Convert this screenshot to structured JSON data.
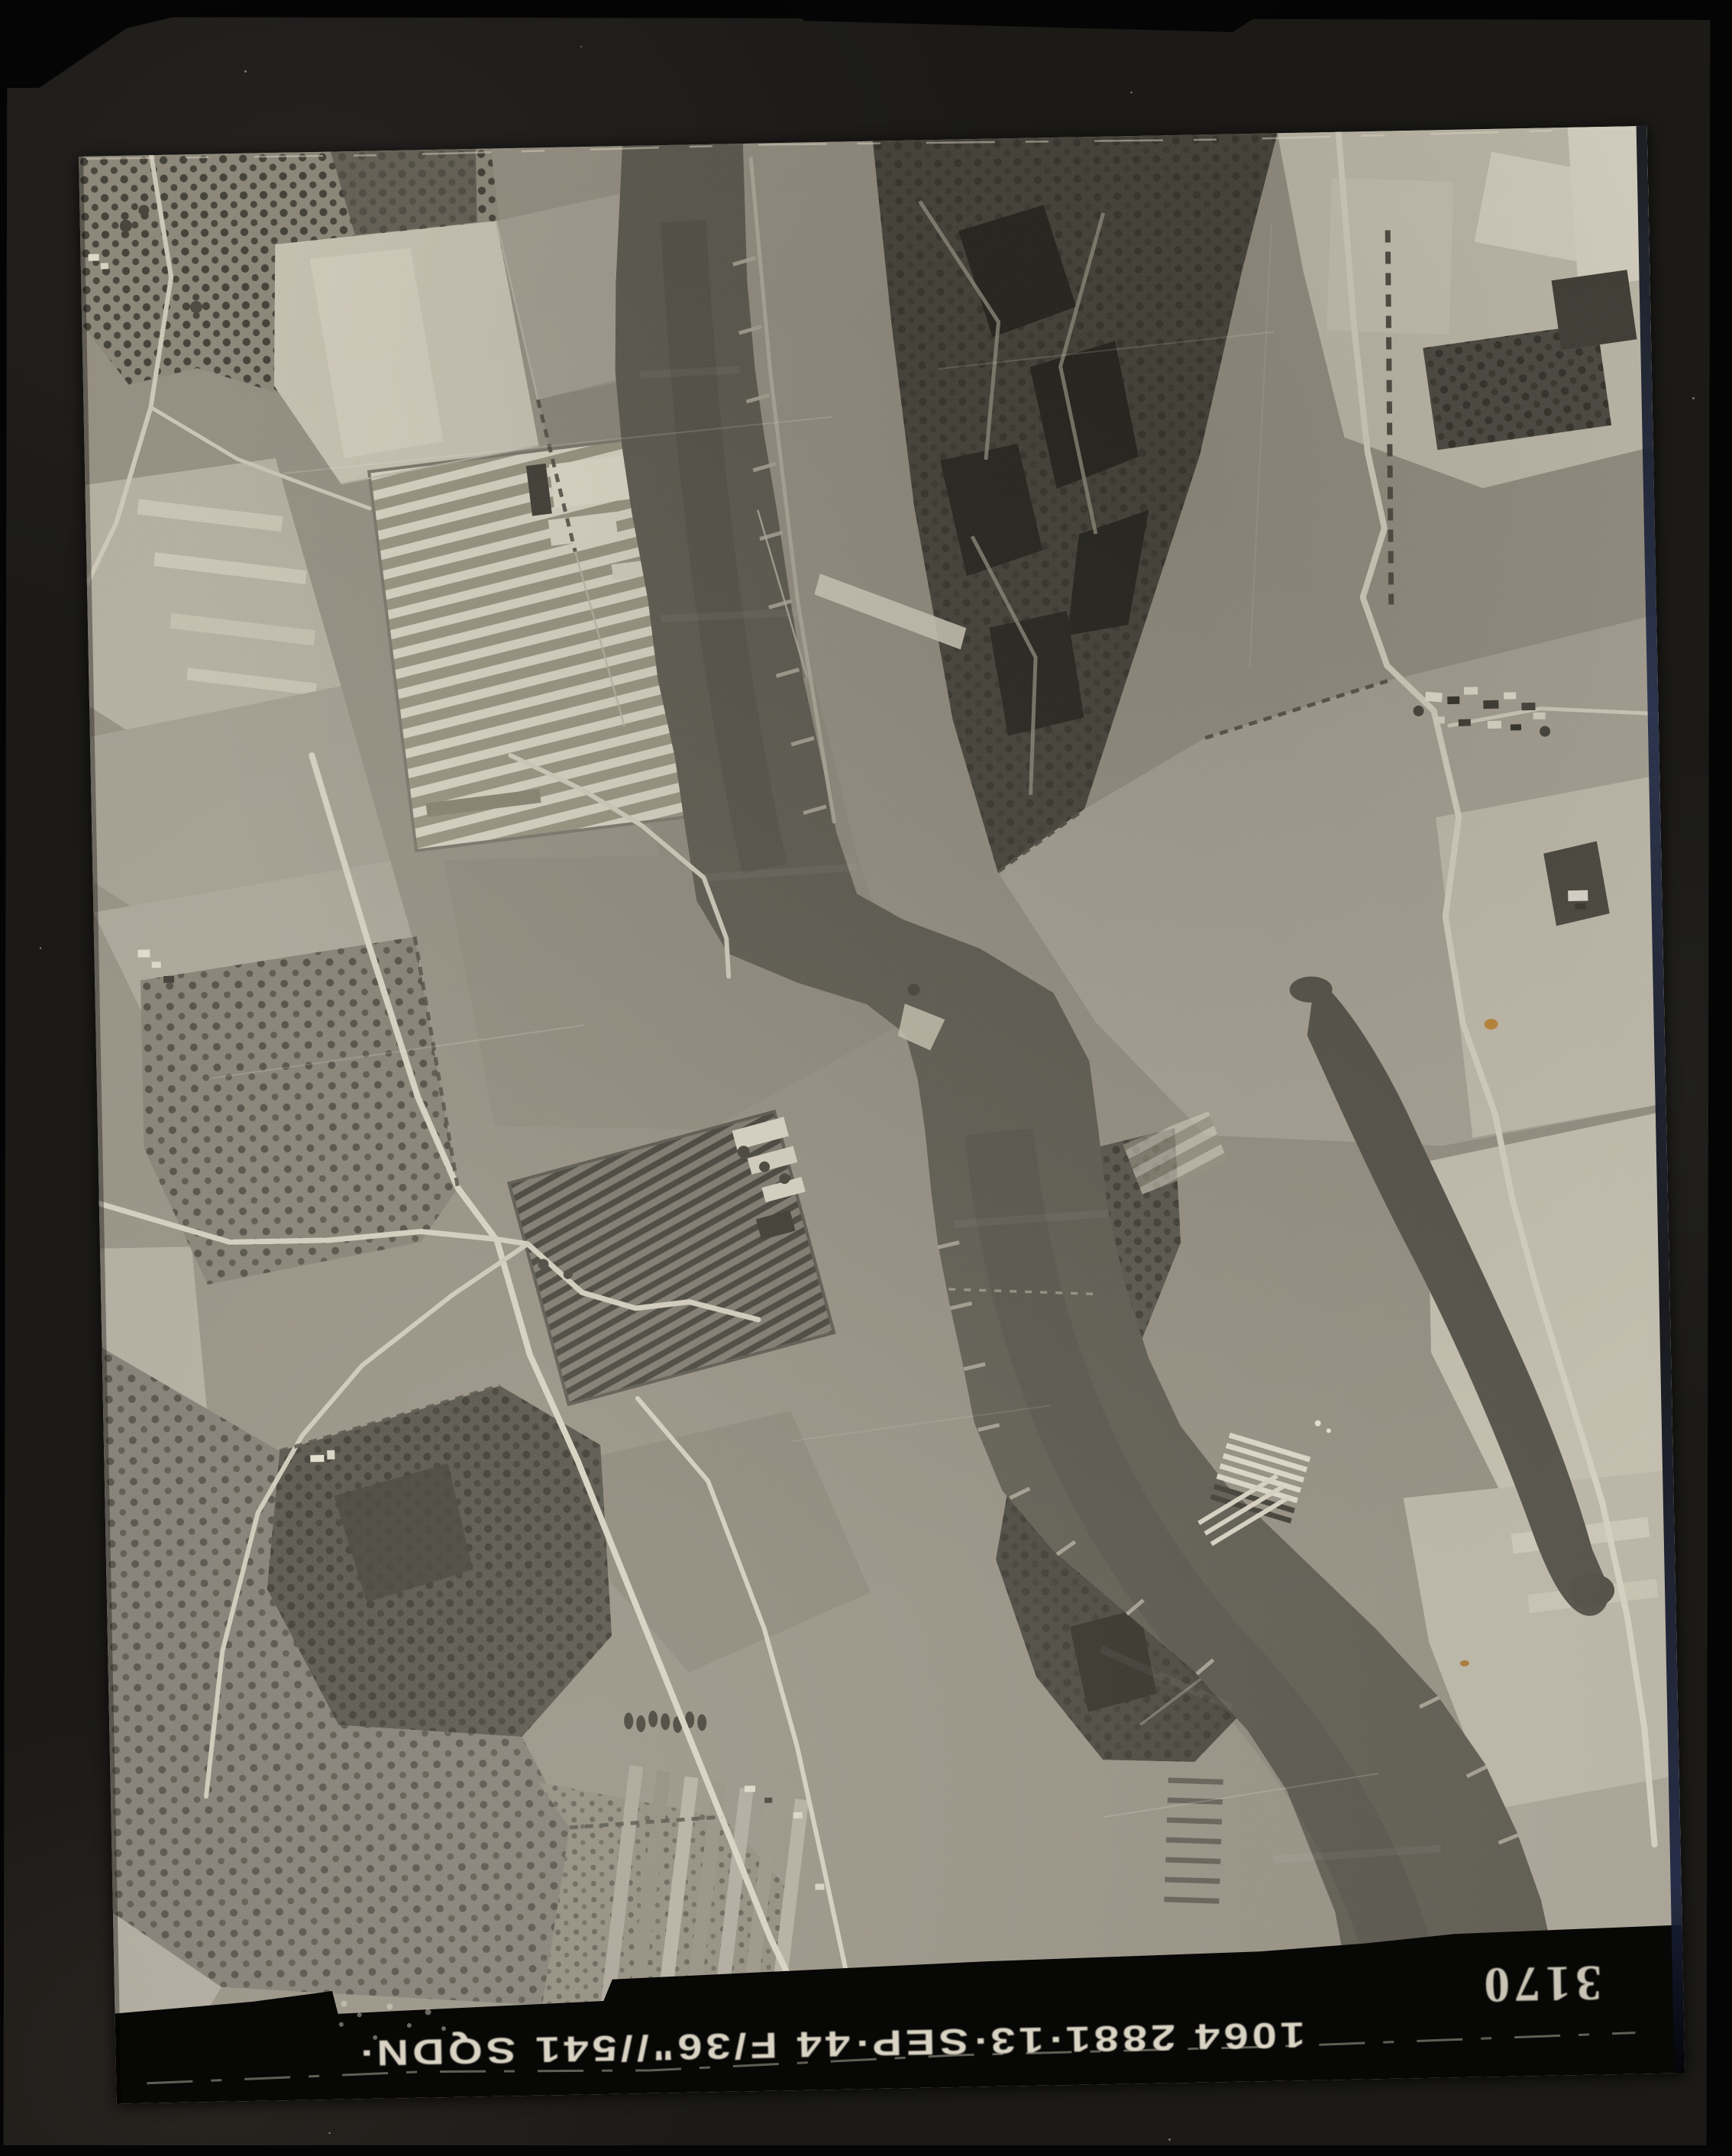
{
  "artifact": {
    "type": "scanned aerial reconnaissance photograph",
    "description": "Vertical black-and-white aerial photograph of a winding river with field patchwork, orchards, nurseries and marsh workings, mounted on dark card; sortie annotations are printed upside-down along the lower film rebate"
  },
  "annotations": {
    "sortie_caption": "1064  2881·13·SEP·44  F/36\"//541 SQDN·",
    "print_number": "3170",
    "orientation": "upside-down"
  },
  "palette": {
    "outer_black": "#050505",
    "mount_card": "#1b1a17",
    "land_mid": "#948e81",
    "land_light": "#c6c1b1",
    "land_dark": "#6e6a60",
    "water": "#5b584e",
    "marsh_dark": "#33322a",
    "rebate_black": "#070706",
    "caption_ink": "#e9e3d2",
    "damage_fleck": "#b97f2b"
  },
  "scene": {
    "features": [
      "river-channel",
      "side-channel",
      "marsh-workings",
      "field-patchwork",
      "orchards",
      "nursery-a",
      "nursery-b",
      "riverside-farm",
      "village",
      "island-wood",
      "groynes",
      "roads",
      "film-rebate"
    ]
  }
}
